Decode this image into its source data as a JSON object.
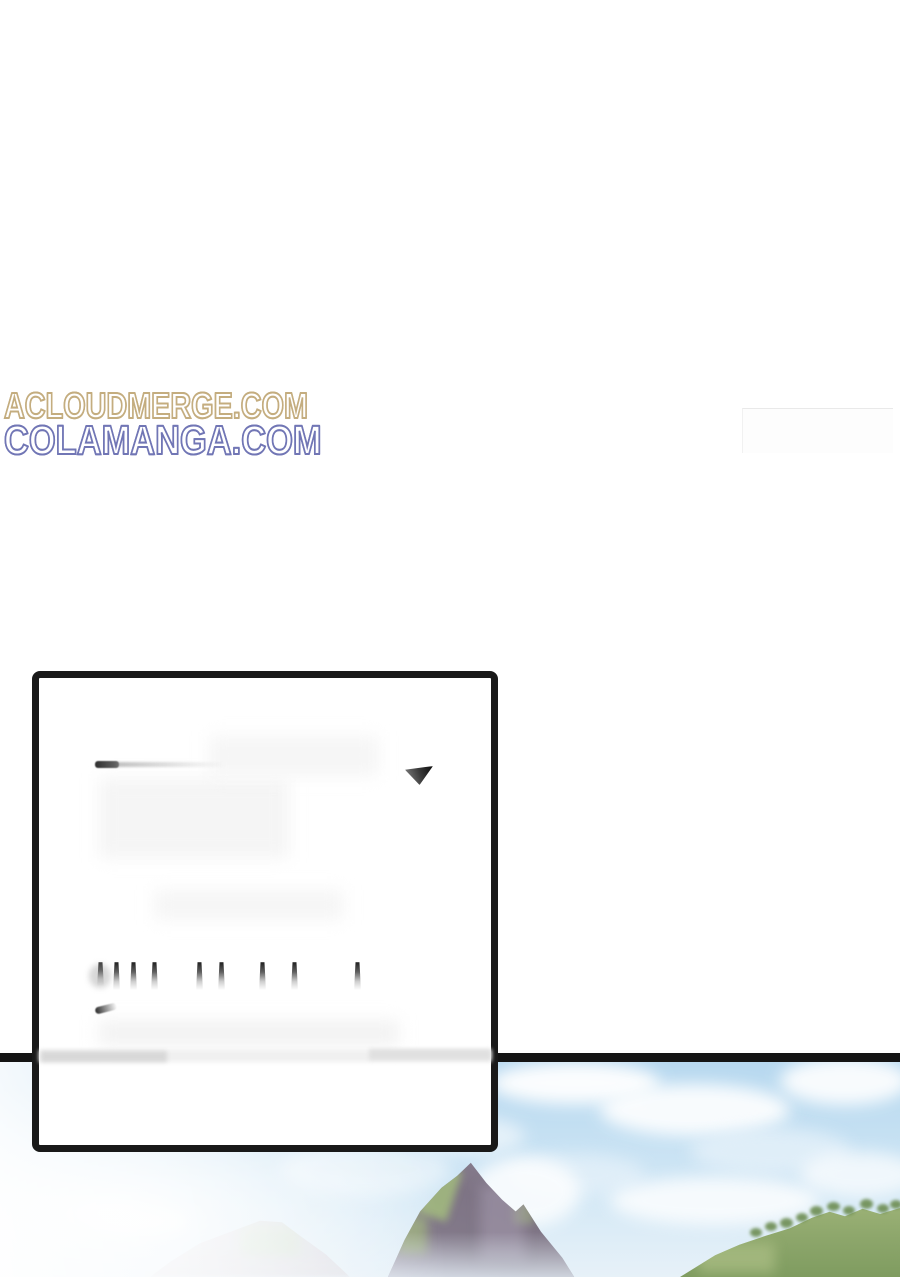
{
  "page": {
    "type": "comic-page",
    "background": "#ffffff",
    "width": 900,
    "height": 1277
  },
  "watermarks": {
    "acloudmerge": {
      "text": "ACLOUDMERGE.COM",
      "color": "#c4ad7f",
      "style": "outline"
    },
    "colamanga": {
      "text": "COLAMANGA.COM",
      "color": "#7176b5",
      "style": "outline"
    }
  },
  "speech_panel": {
    "content": "",
    "note_visual": "empty white panel with partially erased text remnants",
    "border_color": "#191919",
    "background": "#ffffff"
  },
  "landscape": {
    "divider_color": "#141414",
    "sky_color": "#bcdaf0",
    "cloud_color": "#ffffff",
    "mountain_rock_color": "#837a8a",
    "mountain_moss_color": "#a3bc7e",
    "distant_mountain_color": "#c3b2bc",
    "hills_color": "#8ea76c",
    "tree_color": "#6d8d52",
    "haze_color": "#ffffff"
  }
}
